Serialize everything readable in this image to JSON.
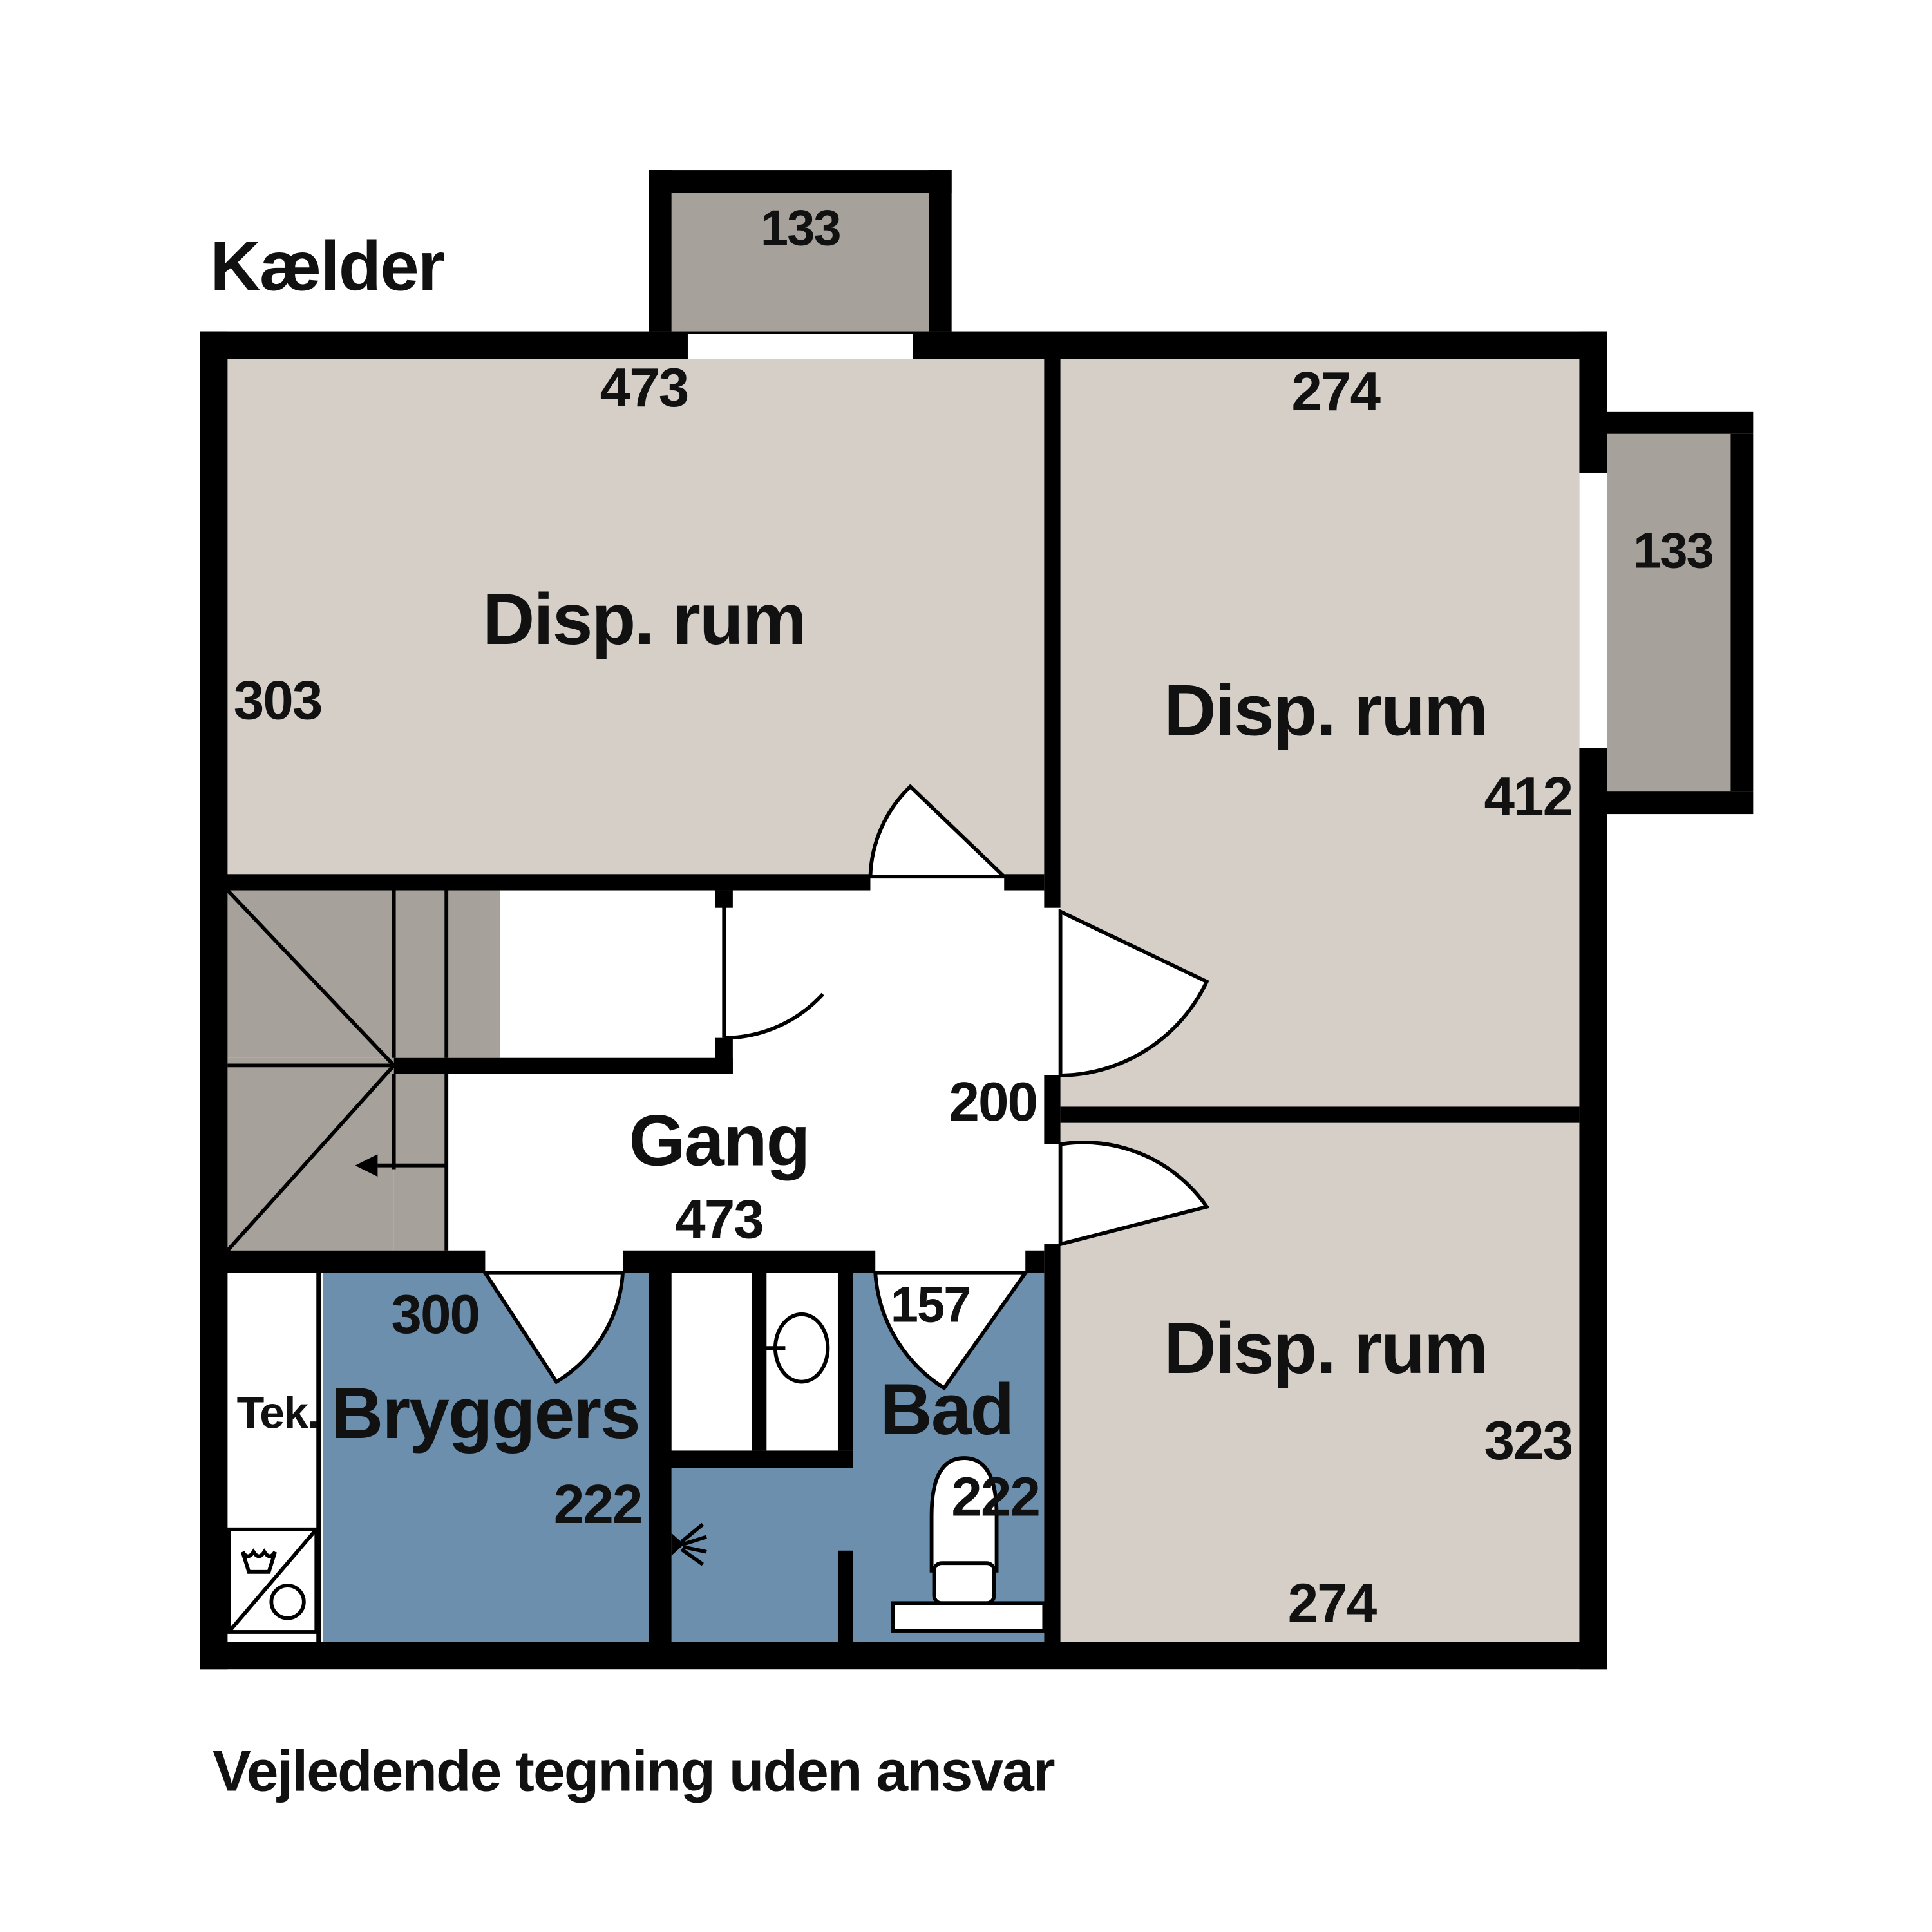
{
  "title": "Kælder",
  "disclaimer": "Vejledende tegning uden ansvar",
  "colors": {
    "wall": "#000000",
    "room_beige": "#d5cfc8",
    "stair_gray": "#a6a19b",
    "wet_room_blue": "#6d8fae",
    "background": "#ffffff",
    "text": "#111111"
  },
  "rooms": {
    "disp_rum_top_left": {
      "name": "Disp. rum",
      "width_cm": "473",
      "height_cm": "303"
    },
    "disp_rum_top_right": {
      "name": "Disp. rum",
      "width_cm": "274",
      "height_cm": "412"
    },
    "disp_rum_bottom_right": {
      "name": "Disp. rum",
      "width_cm": "274",
      "height_cm": "323"
    },
    "gang": {
      "name": "Gang",
      "width_cm": "473",
      "height_cm": "200"
    },
    "bryggers": {
      "name": "Bryggers",
      "width_cm": "300",
      "height_cm": "222"
    },
    "bad": {
      "name": "Bad",
      "width_cm": "157",
      "height_cm": "222"
    },
    "tek": {
      "name": "Tek."
    },
    "window_well_top": {
      "width_cm": "133"
    },
    "window_well_right": {
      "width_cm": "133"
    }
  }
}
